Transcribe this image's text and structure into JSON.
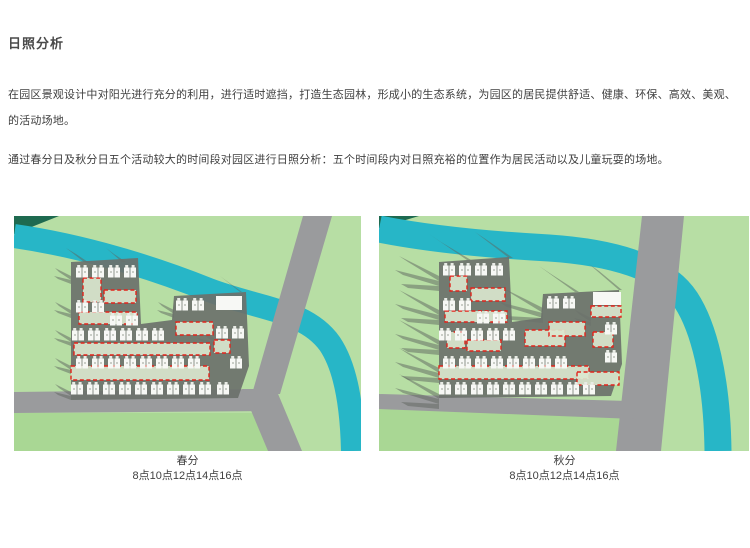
{
  "page": {
    "title": "日照分析"
  },
  "intro": {
    "paragraph1": "在园区景观设计中对阳光进行充分的利用，进行适时遮挡，打造生态园林，形成小的生态系统，为园区的居民提供舒适、健康、环保、高效、美观、的活动场地。",
    "paragraph2": "通过春分日及秋分日五个活动较大的时间段对园区进行日照分析：五个时间段内对日照充裕的位置作为居民活动以及儿童玩耍的场地。"
  },
  "figures": [
    {
      "caption": "春分",
      "times": "8点10点12点14点16点"
    },
    {
      "caption": "秋分",
      "times": "8点10点12点14点16点"
    }
  ],
  "colors": {
    "lawn": "#b7dea4",
    "lawn2": "#a9d794",
    "darkgreen": "#1e6a50",
    "river": "#27b6c7",
    "road": "#9a9b9d",
    "plate": "#6b716b",
    "shadow": "#5f655f",
    "building": "#f7f8f5",
    "building2": "#e8ebe5",
    "red": "#e2231a",
    "hlfill": "#dce8cf",
    "heading_text": "#4a4a4a",
    "body_text": "#404040"
  }
}
